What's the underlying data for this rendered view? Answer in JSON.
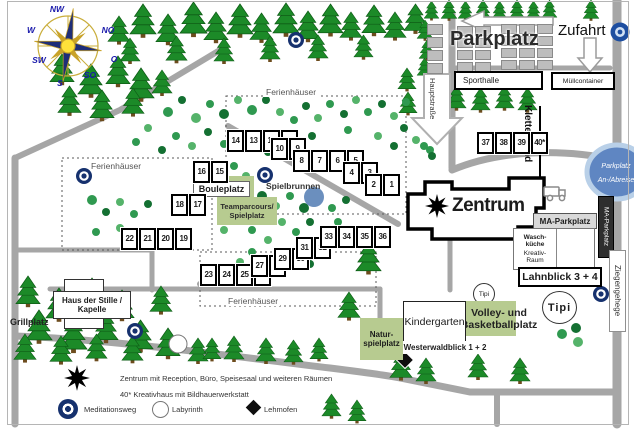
{
  "labels": {
    "parkplatz": "Parkplatz",
    "zufahrt": "Zufahrt",
    "sporthalle": "Sporthalle",
    "muellcontainer": "Müllcontainer",
    "hauptstrasse": "Hauptstraße",
    "kletterwand": "Kletterwand",
    "zentrum": "Zentrum",
    "ma_parkplatz": "MA-Parkplatz",
    "waschkueche": [
      "Wasch-",
      "küche"
    ],
    "kreativraum": [
      "Kreativ-",
      "Raum"
    ],
    "lahnblick": "Lahnblick 3 + 4",
    "ziegengehege": "Ziegengehege",
    "anreise": [
      "Parkplatz",
      "An-/Abreise"
    ],
    "tipi": "Tipi",
    "volleyball": [
      "Volley- und",
      "Basketballplatz"
    ],
    "kindergarten": "Kindergarten",
    "westerwaldblick": "Westerwaldblick 1 + 2",
    "naturspielplatz": [
      "Natur-",
      "spielplatz"
    ],
    "bouleplatz": "Bouleplatz",
    "teamparcours": [
      "Teamparcours/",
      "Spielplatz"
    ],
    "spielbrunnen": "Spielbrunnen",
    "haus_der_stille": [
      "Haus der Stille /",
      "Kapelle"
    ],
    "grillplatz": "Grillplatz",
    "ferienhaeuser": "Ferienhäuser"
  },
  "compass": {
    "nw": "NW",
    "no": "NO",
    "w": "W",
    "o": "O",
    "sw": "SW",
    "so": "SO",
    "s": "S"
  },
  "legend": {
    "zentrum": "Zentrum mit Reception, Büro, Speisesaal und weiteren Räumen",
    "kreativhaus": "40* Kreativhaus mit Bildhauerwerkstatt",
    "meditationsweg": "Meditationsweg",
    "labyrinth": "Labyrinth",
    "lehmofen": "Lehmofen"
  },
  "houses": {
    "groups": [
      {
        "x": 226,
        "y": 129,
        "numbers": [
          "14",
          "13",
          "12",
          "11"
        ]
      },
      {
        "x": 270,
        "y": 137,
        "numbers": [
          "10",
          "9"
        ]
      },
      {
        "x": 292,
        "y": 149,
        "numbers": [
          "8",
          "7",
          "6",
          "5"
        ]
      },
      {
        "x": 342,
        "y": 161,
        "numbers": [
          "4",
          "3"
        ]
      },
      {
        "x": 364,
        "y": 173,
        "numbers": [
          "2",
          "1"
        ]
      },
      {
        "x": 192,
        "y": 160,
        "numbers": [
          "16",
          "15"
        ]
      },
      {
        "x": 170,
        "y": 193,
        "numbers": [
          "18",
          "17"
        ]
      },
      {
        "x": 120,
        "y": 227,
        "numbers": [
          "22",
          "21",
          "20",
          "19"
        ]
      },
      {
        "x": 199,
        "y": 263,
        "numbers": [
          "23",
          "24",
          "25",
          "26"
        ]
      },
      {
        "x": 250,
        "y": 254,
        "numbers": [
          "27",
          "28"
        ]
      },
      {
        "x": 273,
        "y": 247,
        "numbers": [
          "29",
          "30"
        ]
      },
      {
        "x": 295,
        "y": 236,
        "numbers": [
          "31",
          "32"
        ]
      },
      {
        "x": 319,
        "y": 225,
        "numbers": [
          "33",
          "34",
          "35",
          "36"
        ]
      },
      {
        "x": 476,
        "y": 131,
        "numbers": [
          "37",
          "38",
          "39",
          "40*"
        ]
      }
    ]
  },
  "map_markers": {
    "meditation": [
      [
        296,
        40
      ],
      [
        84,
        176
      ],
      [
        265,
        175
      ],
      [
        135,
        331
      ],
      [
        601,
        294
      ]
    ],
    "labyrinth": [
      [
        178,
        344
      ]
    ],
    "lehmofen": [
      [
        405,
        360
      ]
    ]
  },
  "vegetation": {
    "bush_palette": [
      "#2f9950",
      "#147032",
      "#55b36a"
    ],
    "trees": [
      [
        108,
        16,
        1.1
      ],
      [
        130,
        4,
        1.3
      ],
      [
        156,
        14,
        1.2
      ],
      [
        180,
        2,
        1.35
      ],
      [
        204,
        12,
        1.2
      ],
      [
        227,
        4,
        1.3
      ],
      [
        250,
        13,
        1.15
      ],
      [
        273,
        3,
        1.3
      ],
      [
        296,
        11,
        1.2
      ],
      [
        318,
        4,
        1.25
      ],
      [
        340,
        12,
        1.1
      ],
      [
        362,
        5,
        1.2
      ],
      [
        384,
        12,
        1.1
      ],
      [
        404,
        4,
        1.15
      ],
      [
        120,
        38,
        1.0
      ],
      [
        166,
        36,
        1.05
      ],
      [
        214,
        38,
        1.0
      ],
      [
        260,
        36,
        1.0
      ],
      [
        308,
        35,
        1.0
      ],
      [
        354,
        35,
        0.95
      ],
      [
        50,
        54,
        1.2
      ],
      [
        78,
        64,
        1.3
      ],
      [
        106,
        56,
        1.2
      ],
      [
        128,
        68,
        1.3
      ],
      [
        58,
        86,
        1.15
      ],
      [
        90,
        90,
        1.2
      ],
      [
        122,
        88,
        1.1
      ],
      [
        152,
        70,
        1.0
      ],
      [
        424,
        1,
        0.75
      ],
      [
        441,
        0,
        0.8
      ],
      [
        458,
        1,
        0.75
      ],
      [
        475,
        0,
        0.8
      ],
      [
        492,
        1,
        0.75
      ],
      [
        509,
        0,
        0.8
      ],
      [
        526,
        1,
        0.75
      ],
      [
        542,
        0,
        0.75
      ],
      [
        583,
        0,
        0.8
      ],
      [
        417,
        20,
        0.8
      ],
      [
        419,
        40,
        0.8
      ],
      [
        417,
        58,
        0.75
      ],
      [
        398,
        68,
        0.9
      ],
      [
        399,
        92,
        0.9
      ],
      [
        447,
        86,
        0.95
      ],
      [
        471,
        88,
        0.95
      ],
      [
        495,
        86,
        0.95
      ],
      [
        518,
        88,
        0.95
      ],
      [
        356,
        242,
        1.25
      ],
      [
        338,
        292,
        1.1
      ],
      [
        16,
        276,
        1.2
      ],
      [
        46,
        288,
        1.3
      ],
      [
        80,
        278,
        1.2
      ],
      [
        110,
        290,
        1.2
      ],
      [
        26,
        310,
        1.3
      ],
      [
        60,
        318,
        1.35
      ],
      [
        94,
        312,
        1.2
      ],
      [
        128,
        320,
        1.25
      ],
      [
        14,
        334,
        1.1
      ],
      [
        50,
        336,
        1.1
      ],
      [
        86,
        334,
        1.05
      ],
      [
        122,
        336,
        1.05
      ],
      [
        156,
        328,
        1.2
      ],
      [
        188,
        338,
        1.0
      ],
      [
        150,
        286,
        1.1
      ],
      [
        203,
        338,
        0.9
      ],
      [
        224,
        336,
        1.0
      ],
      [
        256,
        338,
        1.0
      ],
      [
        284,
        340,
        0.95
      ],
      [
        310,
        338,
        0.9
      ],
      [
        390,
        352,
        1.1
      ],
      [
        416,
        358,
        1.0
      ],
      [
        468,
        354,
        1.0
      ],
      [
        510,
        358,
        1.0
      ],
      [
        322,
        394,
        0.95
      ],
      [
        348,
        400,
        0.9
      ]
    ],
    "bushes": [
      [
        168,
        112,
        5,
        0
      ],
      [
        182,
        100,
        4,
        1
      ],
      [
        196,
        118,
        5,
        2
      ],
      [
        210,
        104,
        4,
        0
      ],
      [
        224,
        114,
        5,
        1
      ],
      [
        238,
        100,
        4,
        2
      ],
      [
        252,
        110,
        5,
        0
      ],
      [
        266,
        100,
        4,
        1
      ],
      [
        280,
        112,
        4,
        2
      ],
      [
        294,
        120,
        4,
        0
      ],
      [
        306,
        106,
        4,
        1
      ],
      [
        318,
        118,
        4,
        2
      ],
      [
        330,
        104,
        4,
        0
      ],
      [
        344,
        114,
        4,
        1
      ],
      [
        356,
        100,
        4,
        2
      ],
      [
        368,
        112,
        4,
        0
      ],
      [
        382,
        104,
        4,
        1
      ],
      [
        394,
        116,
        4,
        2
      ],
      [
        406,
        102,
        4,
        0
      ],
      [
        404,
        128,
        4,
        1
      ],
      [
        416,
        140,
        4,
        2
      ],
      [
        430,
        150,
        4,
        0
      ],
      [
        394,
        146,
        4,
        1
      ],
      [
        378,
        136,
        4,
        2
      ],
      [
        348,
        130,
        4,
        0
      ],
      [
        312,
        136,
        4,
        1
      ],
      [
        296,
        148,
        4,
        2
      ],
      [
        282,
        138,
        4,
        0
      ],
      [
        268,
        152,
        4,
        1
      ],
      [
        240,
        134,
        4,
        2
      ],
      [
        224,
        144,
        4,
        0
      ],
      [
        208,
        132,
        4,
        1
      ],
      [
        192,
        146,
        4,
        2
      ],
      [
        176,
        136,
        4,
        0
      ],
      [
        162,
        150,
        4,
        1
      ],
      [
        148,
        128,
        4,
        2
      ],
      [
        136,
        142,
        4,
        0
      ],
      [
        262,
        196,
        5,
        1
      ],
      [
        276,
        206,
        4,
        2
      ],
      [
        290,
        196,
        4,
        0
      ],
      [
        304,
        208,
        5,
        1
      ],
      [
        318,
        198,
        4,
        2
      ],
      [
        332,
        208,
        4,
        0
      ],
      [
        346,
        200,
        4,
        1
      ],
      [
        282,
        222,
        4,
        2
      ],
      [
        296,
        232,
        4,
        0
      ],
      [
        310,
        222,
        4,
        1
      ],
      [
        324,
        232,
        4,
        2
      ],
      [
        338,
        222,
        4,
        0
      ],
      [
        352,
        232,
        4,
        1
      ],
      [
        268,
        240,
        4,
        2
      ],
      [
        252,
        230,
        4,
        0
      ],
      [
        238,
        220,
        4,
        1
      ],
      [
        224,
        230,
        4,
        2
      ],
      [
        252,
        252,
        4,
        0
      ],
      [
        266,
        262,
        4,
        1
      ],
      [
        240,
        262,
        4,
        2
      ],
      [
        296,
        256,
        4,
        0
      ],
      [
        310,
        264,
        4,
        1
      ],
      [
        92,
        200,
        5,
        0
      ],
      [
        106,
        212,
        4,
        1
      ],
      [
        120,
        202,
        4,
        2
      ],
      [
        134,
        214,
        4,
        0
      ],
      [
        148,
        204,
        4,
        1
      ],
      [
        120,
        228,
        4,
        2
      ],
      [
        96,
        232,
        4,
        0
      ],
      [
        142,
        236,
        4,
        1
      ],
      [
        424,
        146,
        4,
        0
      ],
      [
        432,
        156,
        4,
        1
      ],
      [
        246,
        176,
        4,
        2
      ],
      [
        234,
        166,
        4,
        0
      ],
      [
        562,
        334,
        5,
        0
      ],
      [
        576,
        328,
        5,
        1
      ],
      [
        578,
        342,
        5,
        2
      ]
    ]
  },
  "colors": {
    "road": "#a6a6a6",
    "tree": "#1c8a28",
    "green_area": "#b7cb90",
    "marker_blue": "#16316e",
    "water": "#6b8fbe",
    "ellipse_blue": "#5f86c2"
  }
}
